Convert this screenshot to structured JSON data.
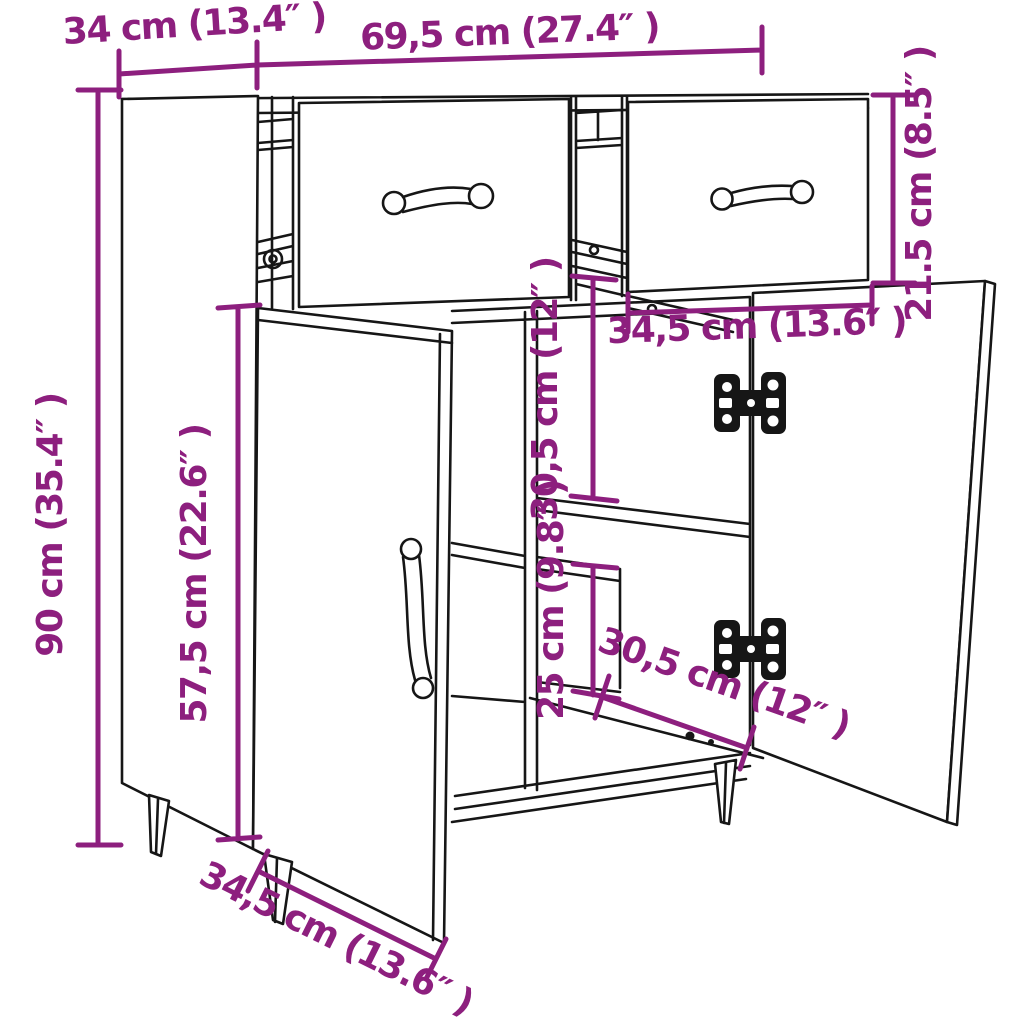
{
  "diagram": {
    "type": "furniture-dimension-diagram",
    "product": "sideboard with 2 drawers and 2 doors",
    "colors": {
      "dimension_accent": "#8d1f7e",
      "line_art": "#161616",
      "background": "#ffffff"
    },
    "dims": [
      {
        "id": "top-depth",
        "label": "34 cm (13.4″ )"
      },
      {
        "id": "top-width",
        "label": "69,5 cm (27.4″ )"
      },
      {
        "id": "drawer-height",
        "label": "21.5 cm (8.5″ )"
      },
      {
        "id": "overall-height",
        "label": "90 cm (35.4″ )"
      },
      {
        "id": "door-height",
        "label": "57,5 cm (22.6″ )"
      },
      {
        "id": "upper-compartment-height",
        "label": "30,5 cm (12″ )"
      },
      {
        "id": "drawer-width",
        "label": "34,5 cm (13.6″ )"
      },
      {
        "id": "lower-compartment-height",
        "label": "25 cm (9.8″ )"
      },
      {
        "id": "interior-depth",
        "label": "30,5 cm (12″ )"
      },
      {
        "id": "door-width",
        "label": "34,5 cm (13.6″ )"
      }
    ]
  }
}
